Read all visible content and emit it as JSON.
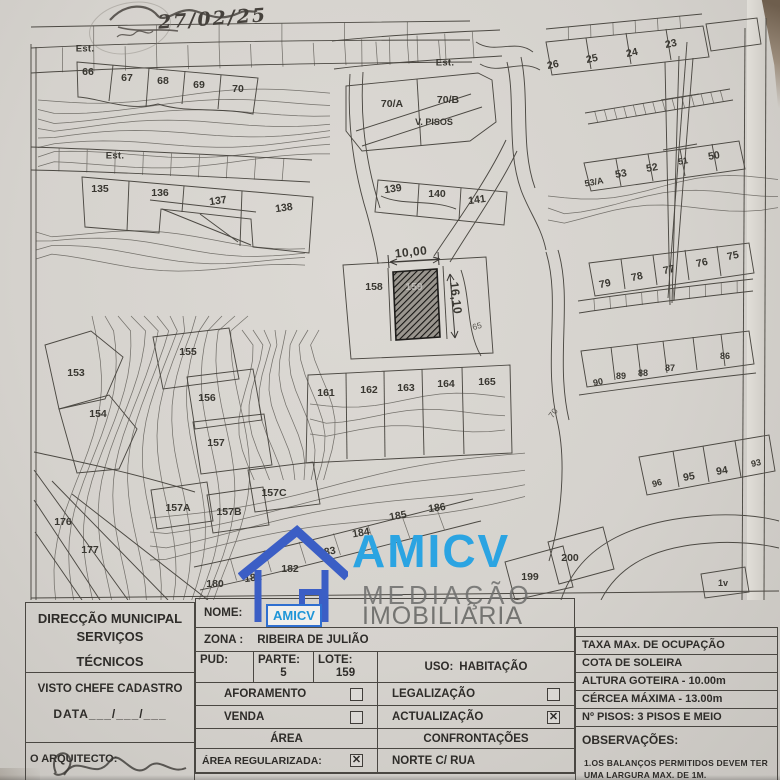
{
  "handwriting": {
    "date": "27/02/25"
  },
  "watermark": {
    "brand": "AMICV",
    "line2": "MEDIAÇÃO",
    "line3": "IMOBILIÁRIA",
    "badge": "AMICV",
    "blue": "#2ba4e2",
    "house_blue": "#3b5ec5"
  },
  "map": {
    "dimension_width": "10,00",
    "dimension_height": "16,10",
    "highlighted_lot": "159",
    "labels": [
      {
        "t": "Est.",
        "x": 85,
        "y": 49,
        "c": "street"
      },
      {
        "t": "66",
        "x": 88,
        "y": 72
      },
      {
        "t": "67",
        "x": 127,
        "y": 78
      },
      {
        "t": "68",
        "x": 163,
        "y": 81
      },
      {
        "t": "69",
        "x": 199,
        "y": 85
      },
      {
        "t": "70",
        "x": 238,
        "y": 89
      },
      {
        "t": "Est.",
        "x": 445,
        "y": 63,
        "c": "street"
      },
      {
        "t": "70/A",
        "x": 392,
        "y": 104
      },
      {
        "t": "70/B",
        "x": 448,
        "y": 100
      },
      {
        "t": "V. PISOS",
        "x": 434,
        "y": 122,
        "c": "small"
      },
      {
        "t": "26",
        "x": 553,
        "y": 65,
        "r": -12
      },
      {
        "t": "25",
        "x": 592,
        "y": 59,
        "r": -12
      },
      {
        "t": "24",
        "x": 632,
        "y": 53,
        "r": -12
      },
      {
        "t": "23",
        "x": 671,
        "y": 44,
        "r": -12
      },
      {
        "t": "Est.",
        "x": 115,
        "y": 156,
        "c": "street"
      },
      {
        "t": "135",
        "x": 100,
        "y": 189
      },
      {
        "t": "136",
        "x": 160,
        "y": 193
      },
      {
        "t": "137",
        "x": 218,
        "y": 201,
        "r": -8
      },
      {
        "t": "138",
        "x": 284,
        "y": 208,
        "r": -8
      },
      {
        "t": "139",
        "x": 393,
        "y": 189,
        "r": -8
      },
      {
        "t": "140",
        "x": 437,
        "y": 194
      },
      {
        "t": "141",
        "x": 477,
        "y": 200,
        "r": -8
      },
      {
        "t": "53/A",
        "x": 594,
        "y": 182,
        "r": -10,
        "c": "small"
      },
      {
        "t": "53",
        "x": 621,
        "y": 174,
        "r": -10
      },
      {
        "t": "52",
        "x": 652,
        "y": 168,
        "r": -10
      },
      {
        "t": "51",
        "x": 683,
        "y": 161,
        "r": -10,
        "c": "small"
      },
      {
        "t": "50",
        "x": 714,
        "y": 156,
        "r": -10
      },
      {
        "t": "10,00",
        "x": 411,
        "y": 252,
        "c": "dim",
        "r": -6
      },
      {
        "t": "158",
        "x": 374,
        "y": 287
      },
      {
        "t": "159",
        "x": 414,
        "y": 287,
        "c": "hatch"
      },
      {
        "t": "16,10",
        "x": 456,
        "y": 298,
        "c": "dim",
        "r": 83
      },
      {
        "t": "65",
        "x": 477,
        "y": 326,
        "r": -15,
        "c": "contour"
      },
      {
        "t": "155",
        "x": 188,
        "y": 352
      },
      {
        "t": "153",
        "x": 76,
        "y": 373
      },
      {
        "t": "156",
        "x": 207,
        "y": 398
      },
      {
        "t": "154",
        "x": 98,
        "y": 414
      },
      {
        "t": "157",
        "x": 216,
        "y": 443
      },
      {
        "t": "161",
        "x": 326,
        "y": 393
      },
      {
        "t": "162",
        "x": 369,
        "y": 390
      },
      {
        "t": "163",
        "x": 406,
        "y": 388
      },
      {
        "t": "164",
        "x": 446,
        "y": 384
      },
      {
        "t": "165",
        "x": 487,
        "y": 382
      },
      {
        "t": "70",
        "x": 553,
        "y": 413,
        "r": -55,
        "c": "contour"
      },
      {
        "t": "75",
        "x": 733,
        "y": 256,
        "r": -12
      },
      {
        "t": "76",
        "x": 702,
        "y": 263,
        "r": -12
      },
      {
        "t": "77",
        "x": 669,
        "y": 270,
        "r": -12
      },
      {
        "t": "78",
        "x": 637,
        "y": 277,
        "r": -12
      },
      {
        "t": "79",
        "x": 605,
        "y": 284,
        "r": -12
      },
      {
        "t": "86",
        "x": 725,
        "y": 356,
        "c": "small"
      },
      {
        "t": "87",
        "x": 670,
        "y": 368,
        "c": "small"
      },
      {
        "t": "88",
        "x": 643,
        "y": 373,
        "c": "small"
      },
      {
        "t": "89",
        "x": 621,
        "y": 376,
        "c": "small"
      },
      {
        "t": "90",
        "x": 598,
        "y": 382,
        "r": -12,
        "c": "small"
      },
      {
        "t": "157C",
        "x": 274,
        "y": 493
      },
      {
        "t": "157A",
        "x": 178,
        "y": 508
      },
      {
        "t": "157B",
        "x": 229,
        "y": 512
      },
      {
        "t": "176",
        "x": 63,
        "y": 522
      },
      {
        "t": "177",
        "x": 90,
        "y": 550
      },
      {
        "t": "186",
        "x": 437,
        "y": 508,
        "r": -8
      },
      {
        "t": "185",
        "x": 398,
        "y": 516,
        "r": -10
      },
      {
        "t": "184",
        "x": 361,
        "y": 533,
        "r": -10
      },
      {
        "t": "183",
        "x": 327,
        "y": 552,
        "r": -10
      },
      {
        "t": "182",
        "x": 290,
        "y": 569
      },
      {
        "t": "181",
        "x": 253,
        "y": 578,
        "r": -8
      },
      {
        "t": "180",
        "x": 215,
        "y": 584
      },
      {
        "t": "200",
        "x": 570,
        "y": 558
      },
      {
        "t": "199",
        "x": 530,
        "y": 577
      },
      {
        "t": "93",
        "x": 756,
        "y": 463,
        "r": -12,
        "c": "small"
      },
      {
        "t": "94",
        "x": 722,
        "y": 471,
        "r": -10
      },
      {
        "t": "95",
        "x": 689,
        "y": 477,
        "r": -10
      },
      {
        "t": "96",
        "x": 657,
        "y": 483,
        "r": -15,
        "c": "small"
      },
      {
        "t": "1v",
        "x": 723,
        "y": 583,
        "c": "small"
      }
    ]
  },
  "form": {
    "left": {
      "title1": "DIRECÇÃO MUNICIPAL",
      "title2": "SERVIÇOS",
      "title3": "TÉCNICOS",
      "visto": "VISTO CHEFE CADASTRO",
      "data": "DATA___/___/___",
      "arquitecto": "O ARQUITECTO:"
    },
    "middle": {
      "nome": "NOME:",
      "zona_label": "ZONA :",
      "zona_value": "RIBEIRA DE JULIÃO",
      "pud": "PUD:",
      "parte_label": "PARTE:",
      "parte_value": "5",
      "lote_label": "LOTE:",
      "lote_value": "159",
      "uso_label": "USO:",
      "uso_value": "HABITAÇÃO",
      "aforamento": "AFORAMENTO",
      "legalizacao": "LEGALIZAÇÃO",
      "venda": "VENDA",
      "actualizacao": "ACTUALIZAÇÃO",
      "area": "ÁREA",
      "confrontacoes": "CONFRONTAÇÕES",
      "area_reg": "ÁREA REGULARIZADA:",
      "norte": "NORTE C/ RUA",
      "checks": {
        "aforamento": false,
        "legalizacao": false,
        "venda": false,
        "actualizacao": true,
        "area_reg": true
      }
    },
    "right": {
      "rows": [
        "TAXA MAx. DE OCUPAÇÃO",
        "COTA DE SOLEIRA",
        "ALTURA GOTEIRA -  10.00m",
        "CÉRCEA  MÁXIMA -  13.00m",
        "Nº PISOS: 3 PISOS E MEIO"
      ],
      "obs_label": "OBSERVAÇÕES:",
      "obs_note": "1.OS BALANÇOS PERMITIDOS DEVEM TER UMA LARGURA MAX. DE 1M."
    }
  }
}
